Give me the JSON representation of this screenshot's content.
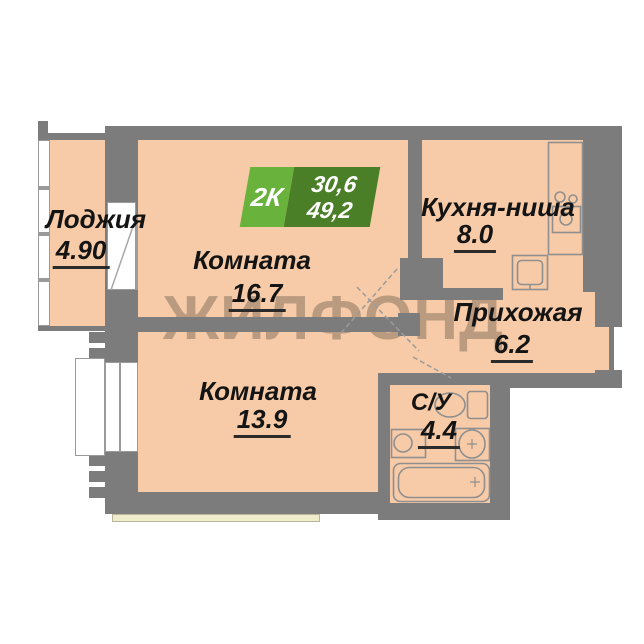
{
  "plan": {
    "watermark": "ЖИЛФОНД",
    "badge": {
      "type": "2К",
      "area_top": "30,6",
      "area_bottom": "49,2"
    },
    "rooms": [
      {
        "name": "Лоджия",
        "area": "4.90"
      },
      {
        "name": "Комната",
        "area": "16.7"
      },
      {
        "name": "Комната",
        "area": "13.9"
      },
      {
        "name": "Кухня-ниша",
        "area": "8.0"
      },
      {
        "name": "Прихожая",
        "area": "6.2"
      },
      {
        "name": "С/У",
        "area": "4.4"
      }
    ],
    "colors": {
      "room_fill": "#f7cba7",
      "wall": "#7c7c7c",
      "cream": "#efeccb",
      "badge_light_green": "#69b23c",
      "badge_dark_green": "#4a7e27",
      "line": "#8f8f8f"
    }
  }
}
